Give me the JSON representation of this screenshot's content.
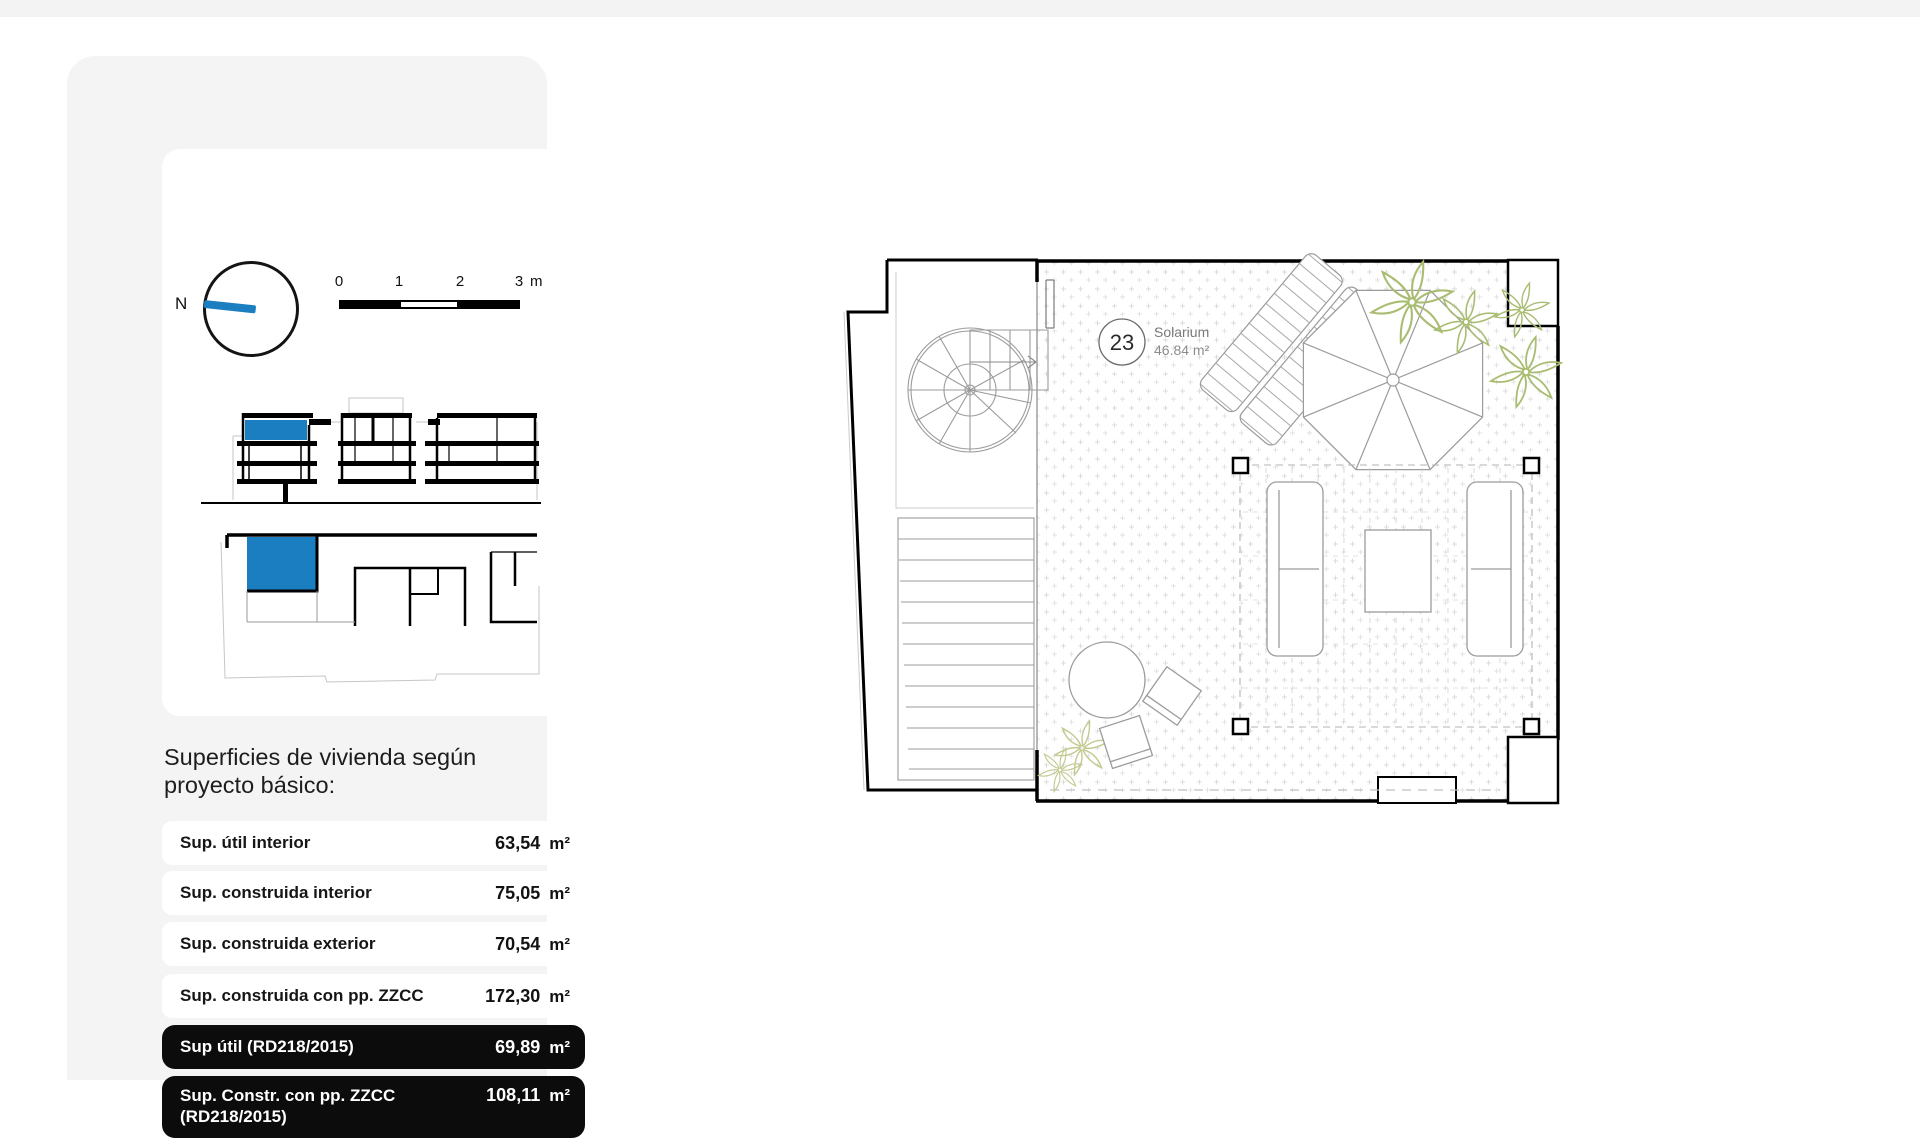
{
  "sidebar": {
    "compass": {
      "north_label": "N"
    },
    "scalebar": {
      "tick0": "0",
      "tick1": "1",
      "tick2": "2",
      "tick3": "3",
      "unit": "m"
    },
    "heading": {
      "line1": "Superficies de vivienda según",
      "line2": "proyecto básico:"
    },
    "rows": [
      {
        "label": "Sup. útil interior",
        "value": "63,54",
        "unit": "m²"
      },
      {
        "label": "Sup. construida interior",
        "value": "75,05",
        "unit": "m²"
      },
      {
        "label": "Sup. construida exterior",
        "value": "70,54",
        "unit": "m²"
      },
      {
        "label": "Sup. construida con pp. ZZCC",
        "value": "172,30",
        "unit": "m²"
      },
      {
        "label": "Sup útil (RD218/2015)",
        "value": "69,89",
        "unit": "m²"
      },
      {
        "label": "Sup. Constr. con pp. ZZCC (RD218/2015)",
        "value": "108,11",
        "unit": "m²"
      }
    ]
  },
  "floorplan": {
    "unit_number": "23",
    "room_name": "Solarium",
    "room_area": "46.84 m²"
  },
  "colors": {
    "accent_blue": "#1b7ec0",
    "dark_row_bg": "#0c0c0c",
    "plant_green": "#a9bd72",
    "plant_olive": "#c3c98f"
  }
}
